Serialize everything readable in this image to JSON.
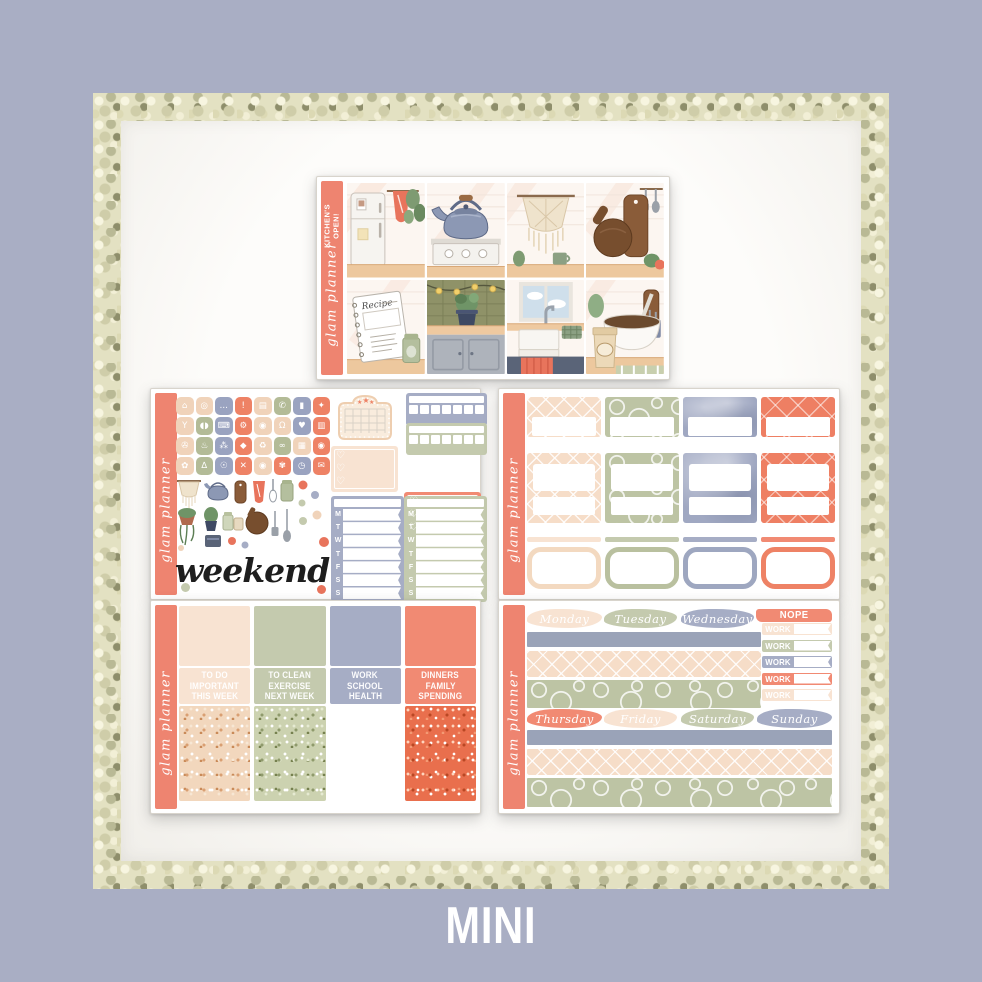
{
  "page": {
    "size_label": "MINI",
    "background_color": "#a9aec4",
    "frame_style": "sage-gold-glitter-border",
    "panel_color": "#fbfaf8"
  },
  "brand": {
    "script_label": "glam planner",
    "sidebar_color": "#ee8470"
  },
  "palette": {
    "coral": "#f18a73",
    "peach": "#f8e3d2",
    "sage": "#c4caae",
    "lavender": "#a6adc5",
    "silver_glitter": "#9aa3b8"
  },
  "sheets": {
    "weekly_kit": {
      "sidebar_title": "KITCHEN'S\nOPEN!",
      "theme": "kitchen",
      "boxes": [
        "fridge-with-towel",
        "kettle-on-stove",
        "macrame-wall-hanging",
        "cutting-boards",
        "recipe-book",
        "counter-plant-with-lights",
        "farmhouse-sink",
        "mixing-bowl-and-sugar"
      ]
    },
    "icons_sampler": {
      "weekend_label": "weekend",
      "weekday_letters": "MTWTFSS",
      "grid": [
        {
          "name": "home",
          "color": "peach",
          "glyph": "⌂"
        },
        {
          "name": "laundry",
          "color": "peach",
          "glyph": "◎"
        },
        {
          "name": "chat",
          "color": "lavender",
          "glyph": "…"
        },
        {
          "name": "alert",
          "color": "coral",
          "glyph": "!"
        },
        {
          "name": "book",
          "color": "peach",
          "glyph": "▤"
        },
        {
          "name": "phone",
          "color": "sage",
          "glyph": "✆"
        },
        {
          "name": "nail-polish",
          "color": "lavender",
          "glyph": "▮"
        },
        {
          "name": "sneaker",
          "color": "coral",
          "glyph": "✦"
        },
        {
          "name": "cheers",
          "color": "peach",
          "glyph": "Y"
        },
        {
          "name": "pill",
          "color": "sage",
          "glyph": "◖◗"
        },
        {
          "name": "laptop",
          "color": "lavender",
          "glyph": "⌨"
        },
        {
          "name": "tractor",
          "color": "coral",
          "glyph": "⚙"
        },
        {
          "name": "donut",
          "color": "peach",
          "glyph": "◉"
        },
        {
          "name": "tooth",
          "color": "peach",
          "glyph": "Ω"
        },
        {
          "name": "heart",
          "color": "lavender",
          "glyph": "♥"
        },
        {
          "name": "credit-card",
          "color": "coral",
          "glyph": "▥"
        },
        {
          "name": "hair-dryer",
          "color": "peach",
          "glyph": "✇"
        },
        {
          "name": "faucet",
          "color": "sage",
          "glyph": "♨"
        },
        {
          "name": "spray-bottle",
          "color": "lavender",
          "glyph": "⁂"
        },
        {
          "name": "car",
          "color": "coral",
          "glyph": "◆"
        },
        {
          "name": "recycle",
          "color": "peach",
          "glyph": "♻"
        },
        {
          "name": "rings",
          "color": "sage",
          "glyph": "∞"
        },
        {
          "name": "gift",
          "color": "peach",
          "glyph": "▦"
        },
        {
          "name": "camera",
          "color": "coral",
          "glyph": "◉"
        },
        {
          "name": "balloons",
          "color": "peach",
          "glyph": "✿"
        },
        {
          "name": "scale",
          "color": "sage",
          "glyph": "∆"
        },
        {
          "name": "lightbulb",
          "color": "lavender",
          "glyph": "☉"
        },
        {
          "name": "trash",
          "color": "coral",
          "glyph": "✕"
        },
        {
          "name": "camera-2",
          "color": "peach",
          "glyph": "◉"
        },
        {
          "name": "paw",
          "color": "coral",
          "glyph": "✾"
        },
        {
          "name": "clock",
          "color": "lavender",
          "glyph": "◷"
        },
        {
          "name": "mail",
          "color": "coral",
          "glyph": "✉"
        }
      ],
      "deco_items": [
        "macrame",
        "kettle",
        "cutting-board",
        "tea-towel",
        "jar",
        "hanging-plant",
        "potted-plant",
        "spice-jars",
        "round-board",
        "spatula",
        "spoon",
        "confetti-dots"
      ],
      "tracker_colors": [
        "lavender",
        "sage"
      ],
      "heart_box_colors": [
        "peach",
        "coral"
      ],
      "weekly_box_colors": [
        "lavender",
        "sage"
      ]
    },
    "boxes_sheet": {
      "columns": [
        "peach",
        "sage",
        "lavender",
        "coral"
      ],
      "rows": [
        "patterned-half-box",
        "patterned-box-with-label-and-strip",
        "strip-plus-open-box"
      ]
    },
    "headers_sheet": {
      "columns": [
        {
          "color": "peach",
          "lines": [
            "TO DO",
            "IMPORTANT",
            "THIS WEEK"
          ]
        },
        {
          "color": "sage",
          "lines": [
            "TO CLEAN",
            "EXERCISE",
            "NEXT WEEK"
          ]
        },
        {
          "color": "lavender",
          "lines": [
            "WORK",
            "SCHOOL",
            "HEALTH"
          ]
        },
        {
          "color": "coral",
          "lines": [
            "DINNERS",
            "FAMILY",
            "SPENDING"
          ]
        }
      ]
    },
    "dates_sheet": {
      "nope_label": "NOPE",
      "work_label": "WORK",
      "work_flag_colors": [
        "peach",
        "sage",
        "lavender",
        "coral",
        "peach"
      ],
      "row1": [
        {
          "label": "Monday",
          "color": "peach"
        },
        {
          "label": "Tuesday",
          "color": "sage"
        },
        {
          "label": "Wednesday",
          "color": "lavender"
        }
      ],
      "row2": [
        {
          "label": "Thursday",
          "color": "coral"
        },
        {
          "label": "Friday",
          "color": "peach"
        },
        {
          "label": "Saturday",
          "color": "sage"
        },
        {
          "label": "Sunday",
          "color": "lavender"
        }
      ],
      "washi_strips": [
        "silver-glitter",
        "peach-lattice",
        "sage-swirl"
      ]
    }
  }
}
